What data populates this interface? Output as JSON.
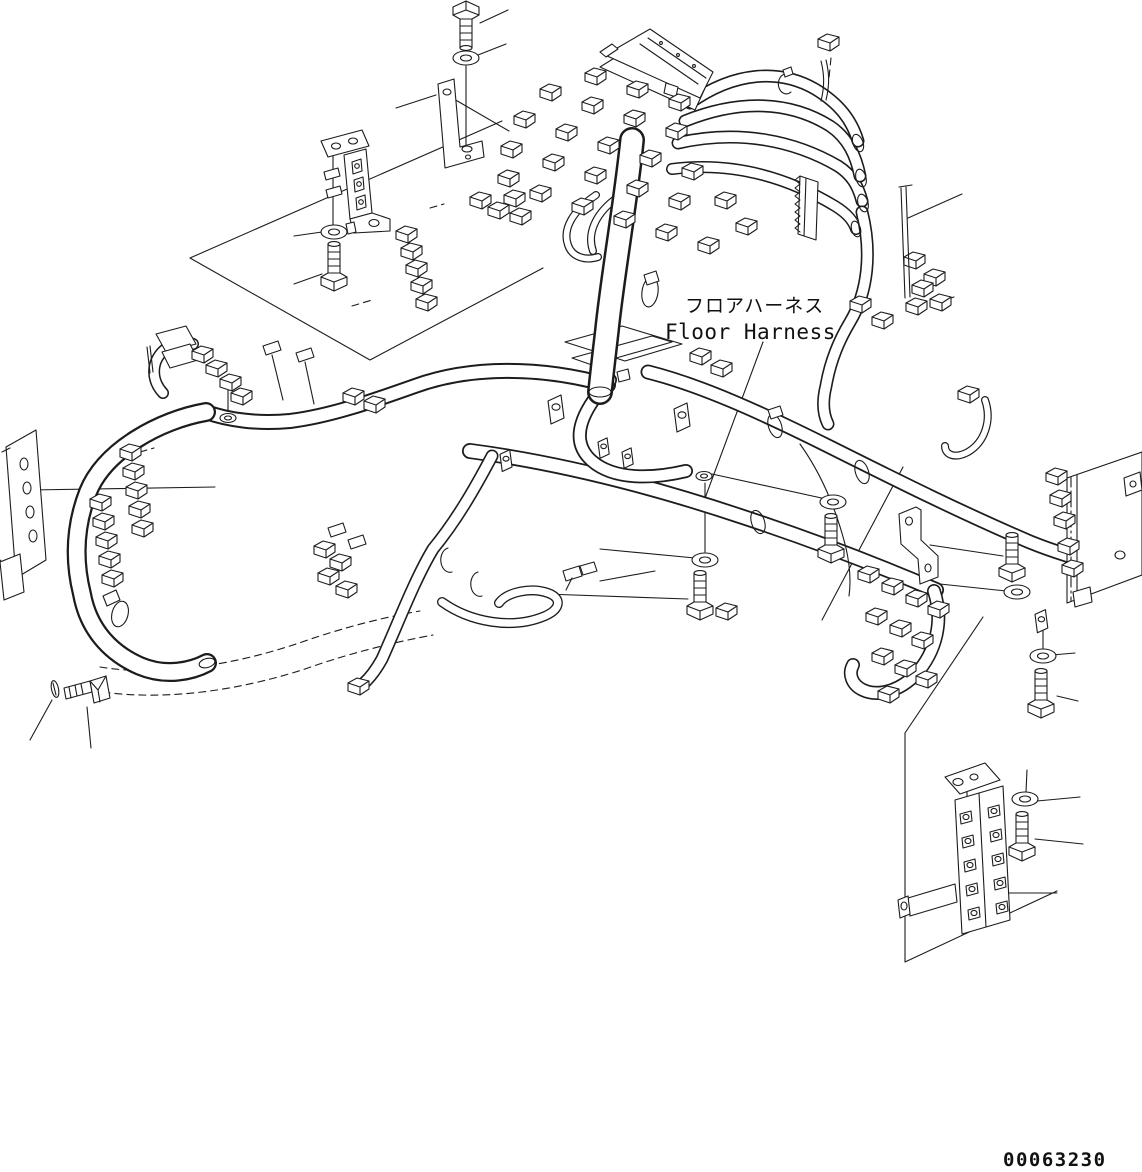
{
  "diagram": {
    "title_jp": "フロアハーネス",
    "title_en": "Floor Harness",
    "part_number": "00063230",
    "line_color": "#1c1c1c",
    "background_color": "#ffffff"
  }
}
